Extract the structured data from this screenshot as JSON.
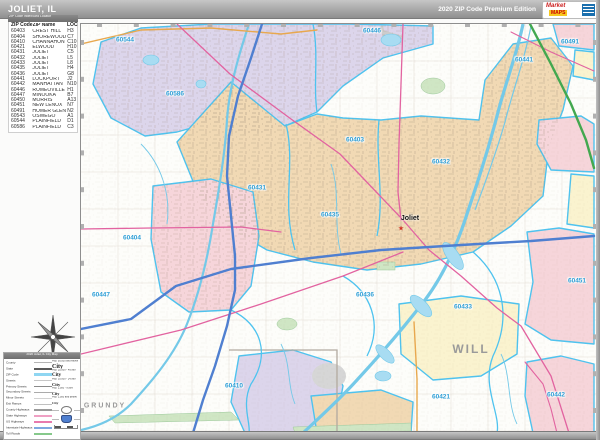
{
  "header": {
    "title": "JOLIET, IL",
    "edition": "2020 ZIP Code Premium Edition",
    "logo": {
      "line1": "Market",
      "line2": "MAPS"
    }
  },
  "zip_index": {
    "header": "ZIP Code Index/Grid Locator",
    "columns": [
      "ZIP Code",
      "ZIP Name",
      "LOC"
    ],
    "rows": [
      [
        "60403",
        "CREST HILL",
        "H3"
      ],
      [
        "60404",
        "SHOREWOOD",
        "C7"
      ],
      [
        "60410",
        "CHANNAHON",
        "C10"
      ],
      [
        "60421",
        "ELWOOD",
        "H10"
      ],
      [
        "60431",
        "JOLIET",
        "C5"
      ],
      [
        "60432",
        "JOLIET",
        "L5"
      ],
      [
        "60433",
        "JOLIET",
        "L8"
      ],
      [
        "60435",
        "JOLIET",
        "H4"
      ],
      [
        "60436",
        "JOLIET",
        "G8"
      ],
      [
        "60441",
        "LOCKPORT",
        "J2"
      ],
      [
        "60442",
        "MANHATTAN",
        "N10"
      ],
      [
        "60446",
        "ROMEOVILLE",
        "H1"
      ],
      [
        "60447",
        "MINOOKA",
        "B7"
      ],
      [
        "60450",
        "MORRIS",
        "A13"
      ],
      [
        "60451",
        "NEW LENOX",
        "N7"
      ],
      [
        "60491",
        "HOMER GLEN",
        "N2"
      ],
      [
        "60543",
        "OSWEGO",
        "A1"
      ],
      [
        "60544",
        "PLAINFIELD",
        "D1"
      ],
      [
        "60586",
        "PLAINFIELD",
        "C3"
      ]
    ]
  },
  "map": {
    "city_marker": {
      "name": "Joliet",
      "symbol": "★"
    },
    "counties": [
      {
        "name": "WILL",
        "x": 390,
        "y": 325,
        "size": 12
      },
      {
        "name": "GRUNDY",
        "x": 24,
        "y": 382,
        "size": 7
      }
    ],
    "zip_labels": [
      {
        "code": "60544",
        "x": 44,
        "y": 16
      },
      {
        "code": "60446",
        "x": 291,
        "y": 7
      },
      {
        "code": "60491",
        "x": 489,
        "y": 18
      },
      {
        "code": "60441",
        "x": 443,
        "y": 36
      },
      {
        "code": "60586",
        "x": 94,
        "y": 70
      },
      {
        "code": "60403",
        "x": 274,
        "y": 116
      },
      {
        "code": "60432",
        "x": 360,
        "y": 138
      },
      {
        "code": "60431",
        "x": 176,
        "y": 164
      },
      {
        "code": "60435",
        "x": 249,
        "y": 191
      },
      {
        "code": "60404",
        "x": 51,
        "y": 214
      },
      {
        "code": "60447",
        "x": 20,
        "y": 271
      },
      {
        "code": "60436",
        "x": 284,
        "y": 271
      },
      {
        "code": "60433",
        "x": 382,
        "y": 283
      },
      {
        "code": "60451",
        "x": 496,
        "y": 257
      },
      {
        "code": "60410",
        "x": 153,
        "y": 362
      },
      {
        "code": "60421",
        "x": 360,
        "y": 373
      },
      {
        "code": "60442",
        "x": 475,
        "y": 371
      }
    ],
    "colors": {
      "zip_label": "#2e9fd6",
      "county_label": "#9a9a9a",
      "region_tan": "#f1d9b4",
      "region_lavender": "#dcd5eb",
      "region_pink": "#f6d5da",
      "region_yellow": "#faf3cf",
      "region_green": "#cfe6c4",
      "water": "#a8dcf2",
      "zip_boundary": "#4ec3ef",
      "interstate": "#4f7fd0",
      "toll_road": "#43a84f",
      "state_highway": "#e263a0",
      "us_highway": "#e8a84e",
      "city_marker": "#d03327"
    }
  },
  "legend": {
    "title": "2020 Joliet, IL City Map",
    "line_items": [
      {
        "label": "County",
        "color": "#b5b5b5",
        "width": 1
      },
      {
        "label": "State",
        "color": "#5a5a5a",
        "width": 2.5
      },
      {
        "label": "ZIP Code",
        "color": "#8fd6f2",
        "width": 3
      },
      {
        "label": "Streets",
        "color": "#c7c7c7",
        "width": 1
      },
      {
        "label": "Primary Streets",
        "color": "#8a8a8a",
        "width": 1.6
      },
      {
        "label": "Secondary Streets",
        "color": "#ababab",
        "width": 1.2
      },
      {
        "label": "Minor Streets",
        "color": "#d2d2d2",
        "width": 1
      },
      {
        "label": "Exit Ramps",
        "color": "#c0c0c0",
        "width": 1
      },
      {
        "label": "County Highways",
        "color": "#9a9a9a",
        "width": 1.4
      },
      {
        "label": "State Highways",
        "color": "#efa0c4",
        "width": 1.8
      },
      {
        "label": "US Highways",
        "color": "#e87aae",
        "width": 1.8
      },
      {
        "label": "Interstate Highways",
        "color": "#7fa9e0",
        "width": 2.2
      },
      {
        "label": "Toll Roads",
        "color": "#86c98b",
        "width": 2.2
      }
    ],
    "city_sizes": [
      {
        "label": "Pop. 50,000 and Above",
        "sample": "City",
        "px": 6
      },
      {
        "label": "Pop. 25,000 - 49,999",
        "sample": "City",
        "px": 5
      },
      {
        "label": "Pop. 10,000 - 24,999",
        "sample": "City",
        "px": 4.5
      },
      {
        "label": "Pop. 2,500 - 9,999",
        "sample": "City",
        "px": 4
      },
      {
        "label": "Pop. 2,500 and Below",
        "sample": "City",
        "px": 3.5
      }
    ]
  }
}
